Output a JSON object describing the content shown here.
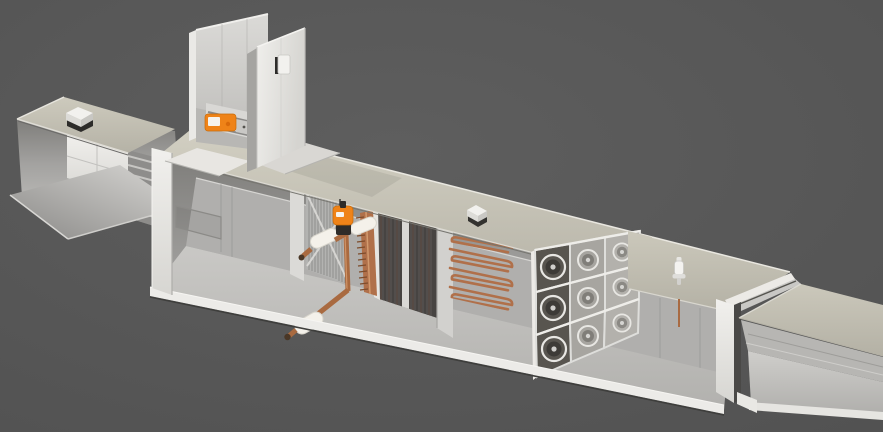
{
  "scene": {
    "title": "Air handling unit — cutaway 3D render",
    "view": "isometric cutaway",
    "background": "#5a5a5a"
  },
  "colors": {
    "bg": "#5a5a5a",
    "roof": "#c8c5b8",
    "roof2": "#c1beb1",
    "white": "#eceae6",
    "panel": "#dddcd8",
    "wall": "#b0afad",
    "floor": "#c5c4c1",
    "dark_coil": "#474442",
    "copper": "#b0704a",
    "copper_dark": "#7e4c2c",
    "insulation": "#f4f1ea",
    "accent_orange": "#ef8318",
    "accent_orange_dark": "#d96a0a",
    "metal": "#d8d7d4",
    "shadow": "#3f3f3f"
  },
  "components": [
    {
      "name": "intake-duct",
      "desc": "open inlet duct with damper and actuator"
    },
    {
      "name": "intake-roof-sensor",
      "desc": "duct-mounted sensor box"
    },
    {
      "name": "exhaust-tower",
      "desc": "vertical discharge tower with damper and actuator"
    },
    {
      "name": "tower-sensor",
      "desc": "wall-mounted sensor box"
    },
    {
      "name": "mixing-chamber",
      "desc": "empty mixing section"
    },
    {
      "name": "filter-wall",
      "desc": "filter frame with cross bracing"
    },
    {
      "name": "coil-block",
      "desc": "finned heat-exchanger coil with copper header"
    },
    {
      "name": "coil-valve",
      "desc": "control valve with orange actuator and insulated piping"
    },
    {
      "name": "heater-coil",
      "desc": "serpentine copper tube bank, 4 rows"
    },
    {
      "name": "fan-wall",
      "desc": "3 x 3 plug fan array"
    },
    {
      "name": "roof-sensor-box",
      "desc": "rooftop sensor"
    },
    {
      "name": "roof-sensor-probe",
      "desc": "rooftop probe with copper rod"
    },
    {
      "name": "outlet-duct",
      "desc": "discharge duct, open cutaway"
    }
  ],
  "fan_grid": {
    "rows": 3,
    "cols": 3
  },
  "heater_rows": 4
}
